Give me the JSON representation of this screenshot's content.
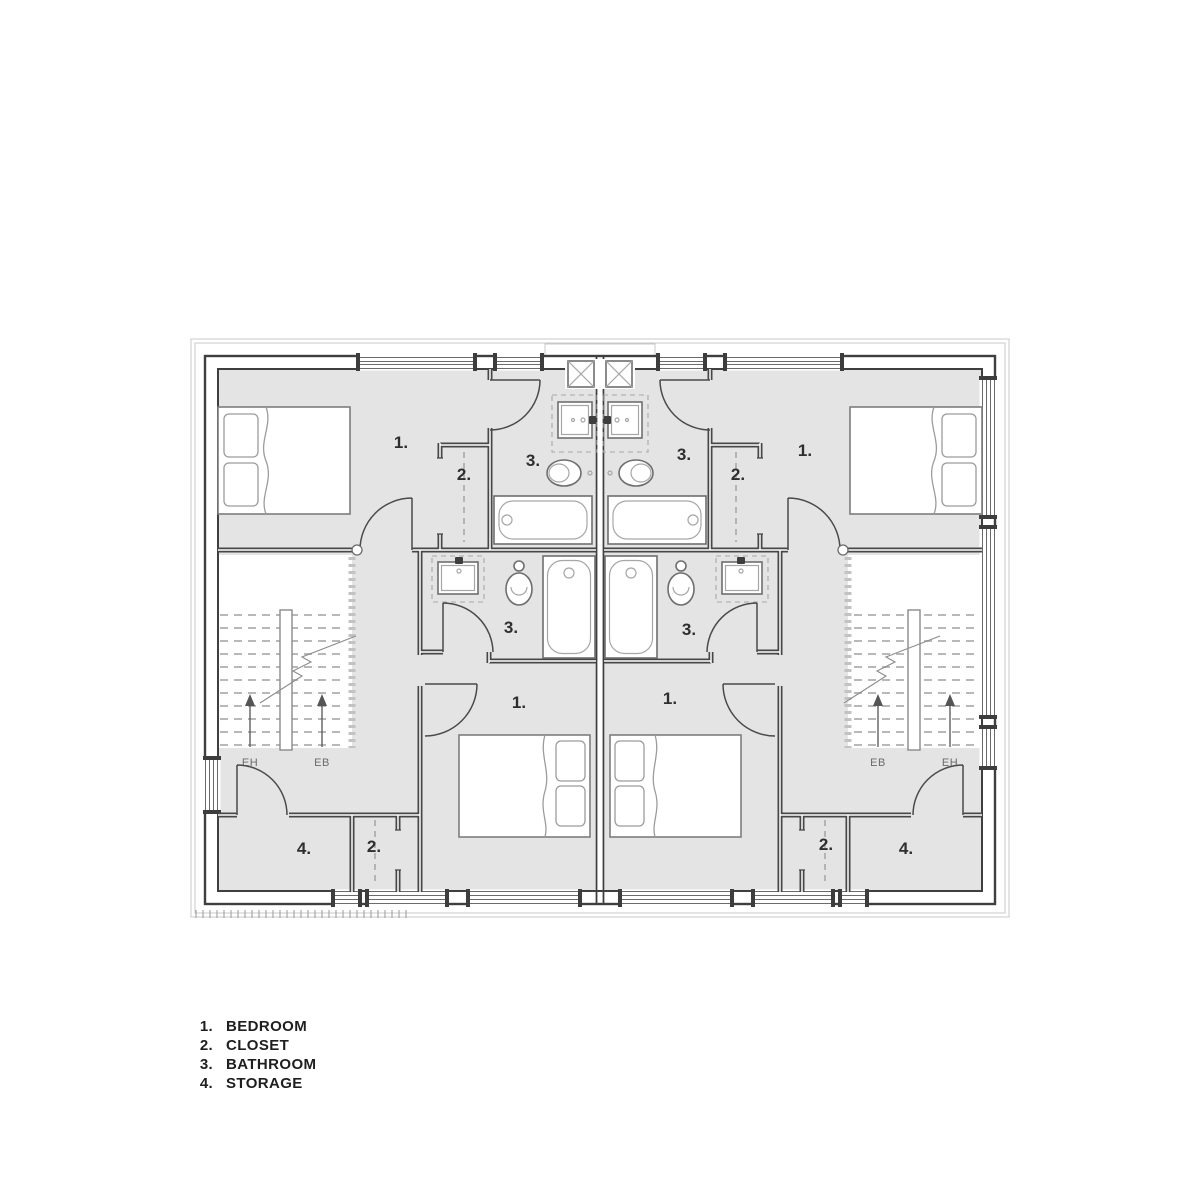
{
  "colors": {
    "floor": "#e4e4e4",
    "wall": "#3f3f3f",
    "fixture": "#6e6e6e",
    "fixture_light": "#a6a6a6"
  },
  "legend": {
    "items": [
      {
        "num": "1.",
        "label": "BEDROOM"
      },
      {
        "num": "2.",
        "label": "CLOSET"
      },
      {
        "num": "3.",
        "label": "BATHROOM"
      },
      {
        "num": "4.",
        "label": "STORAGE"
      }
    ]
  },
  "plan": {
    "labels": {
      "bedroom1_left": "1.",
      "closet1_left": "2.",
      "bath1_left": "3.",
      "bath1_right": "3.",
      "closet1_right": "2.",
      "bedroom1_right": "1.",
      "bath2_left": "3.",
      "bath2_right": "3.",
      "bedroom2_left": "1.",
      "bedroom2_right": "1.",
      "storage_left": "4.",
      "closet2_left": "2.",
      "closet2_right": "2.",
      "storage_right": "4."
    },
    "stairs": {
      "left": {
        "label_a": "EH",
        "label_b": "EB"
      },
      "right": {
        "label_a": "EB",
        "label_b": "EH"
      }
    }
  }
}
